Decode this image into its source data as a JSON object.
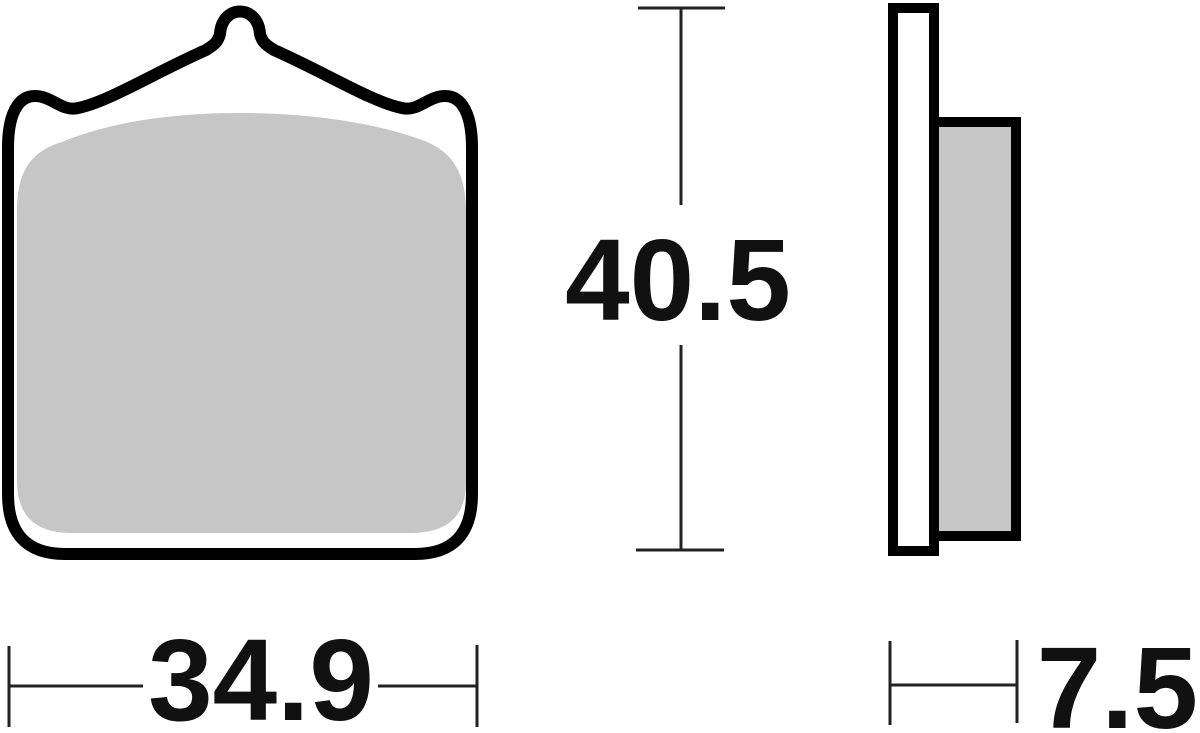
{
  "diagram": {
    "dimensions": {
      "width_label": "34.9",
      "height_label": "40.5",
      "thickness_label": "7.5"
    },
    "colors": {
      "outline": "#000000",
      "dimension_line": "#222222",
      "friction_material": "#c6c6c6",
      "backing_plate": "#ffffff",
      "background": "#ffffff"
    }
  }
}
